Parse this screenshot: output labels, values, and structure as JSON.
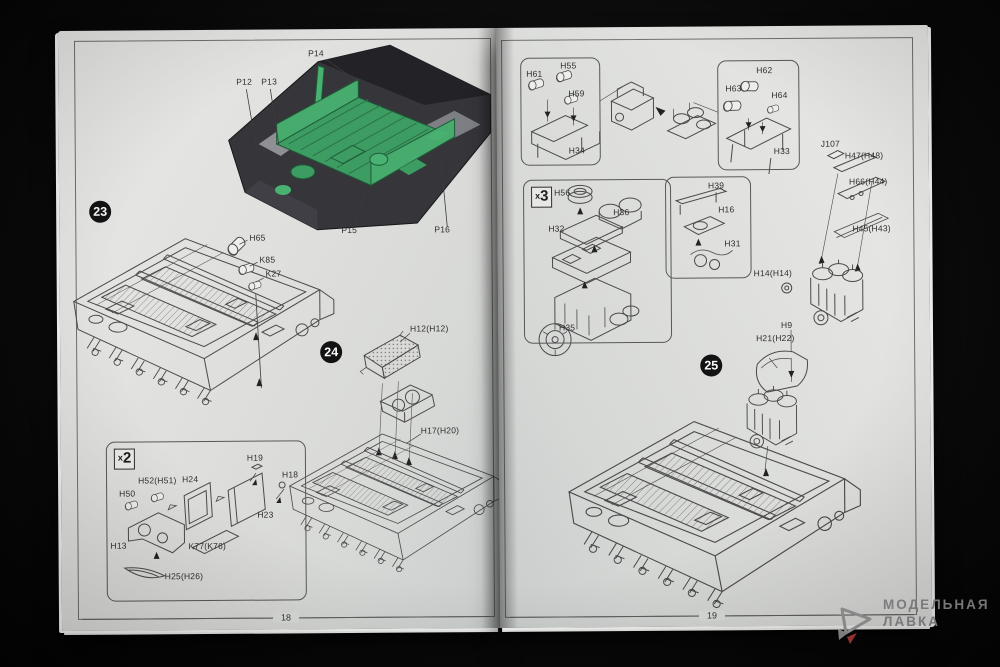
{
  "colors": {
    "background": "#0a0a0a",
    "paper": "#e0e1df",
    "line_art": "#4a4a4a",
    "cad_hull": "#35353a",
    "cad_part_green": "#3f9e63",
    "badge": "#131313",
    "watermark_text": "#8d8d8d",
    "watermark_accent": "#a93a32"
  },
  "left_page": {
    "page_number": "18",
    "render": {
      "labels": {
        "p12": "P12",
        "p13": "P13",
        "p14": "P14",
        "p15": "P15",
        "p16": "P16"
      }
    },
    "step23": {
      "badge": "23",
      "parts": {
        "h65": "H65",
        "k85": "K85",
        "k27": "K27"
      }
    },
    "step24": {
      "badge": "24",
      "parts": {
        "h12": "H12(H12)",
        "h17": "H17(H20)"
      }
    },
    "x2_box": {
      "prefix": "x",
      "value": "2",
      "parts": {
        "h19": "H19",
        "h18": "H18",
        "h52": "H52(H51)",
        "h24": "H24",
        "h50": "H50",
        "h23": "H23",
        "h13": "H13",
        "k77": "K77(K76)",
        "h25": "H25(H26)"
      }
    }
  },
  "right_page": {
    "page_number": "19",
    "box_a": {
      "parts": {
        "h61": "H61",
        "h55": "H55",
        "h59": "H59",
        "h34": "H34"
      }
    },
    "box_b": {
      "parts": {
        "h62": "H62",
        "h63": "H63",
        "h64": "H64",
        "h33": "H33"
      }
    },
    "column": {
      "parts": {
        "j107": "J107",
        "h47": "H47(H48)",
        "h66": "H66(H44)",
        "h45": "H45(H43)",
        "h14": "H14(H14)"
      }
    },
    "x3_box": {
      "prefix": "x",
      "value": "3",
      "parts": {
        "h56": "H56",
        "h36": "H36",
        "h32": "H32",
        "h35": "H35"
      }
    },
    "box_d": {
      "parts": {
        "h39": "H39",
        "h16": "H16",
        "h31": "H31"
      }
    },
    "step25": {
      "badge": "25",
      "parts": {
        "h9": "H9",
        "h21": "H21(H22)"
      }
    }
  },
  "watermark": {
    "line1": "МОДЕЛЬНАЯ",
    "line2": "ЛАВКА",
    "logo": "paper-plane-logo"
  }
}
